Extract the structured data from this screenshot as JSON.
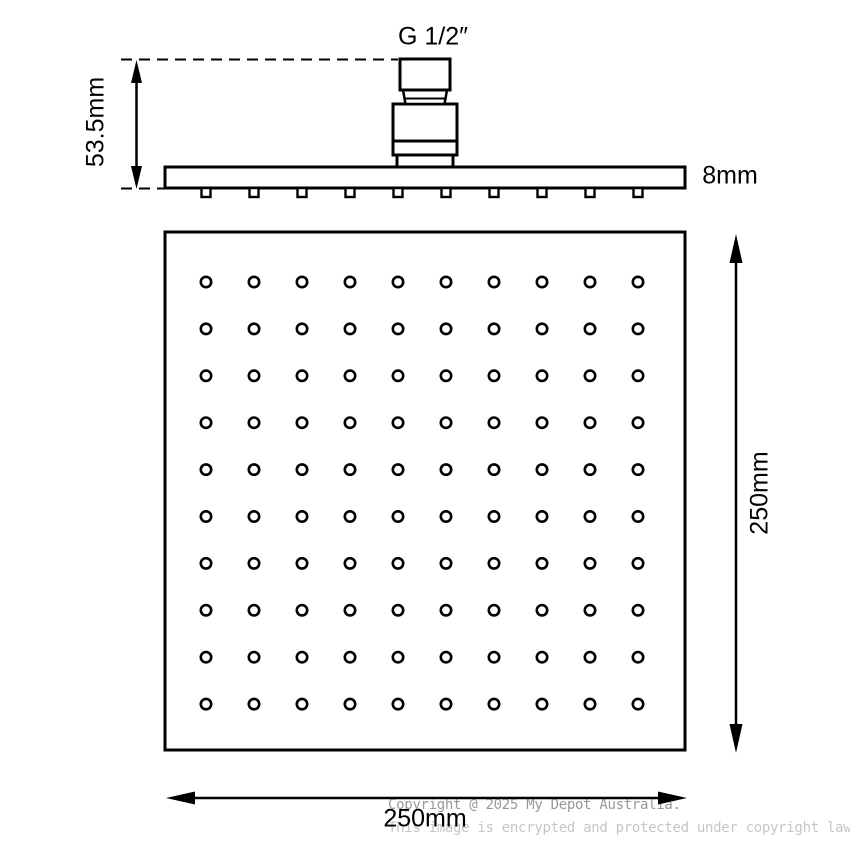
{
  "canvas": {
    "background": "#ffffff",
    "line_color": "#000000"
  },
  "labels": {
    "thread_size": "G 1/2″",
    "head_height": "53.5mm",
    "plate_thickness": "8mm",
    "face_height": "250mm",
    "face_width": "250mm"
  },
  "side_view": {
    "nozzle_count": 10
  },
  "face_view": {
    "grid": {
      "rows": 10,
      "cols": 10
    }
  },
  "watermark": {
    "line1": "Copyright @ 2025 My Depot Australia.",
    "line2": "This image is encrypted and protected under copyright law.",
    "line1_color": "#999999",
    "line2_color": "#c6c6c6"
  }
}
